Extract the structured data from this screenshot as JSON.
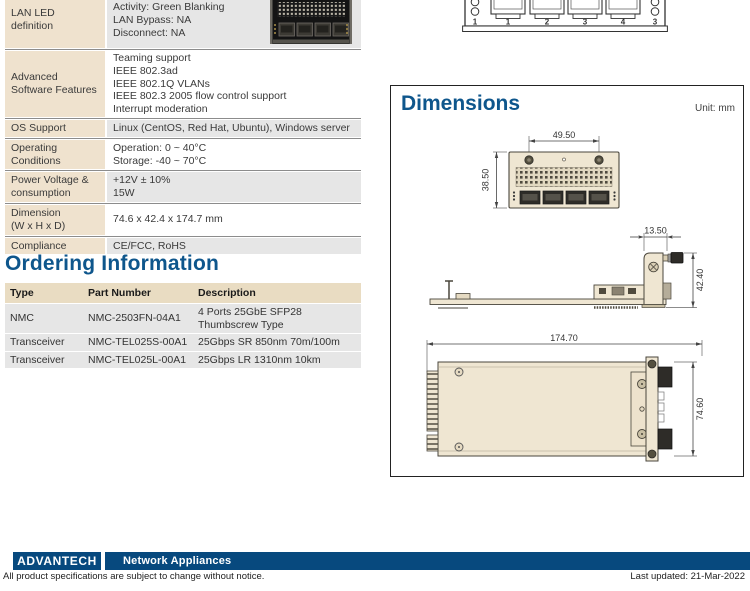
{
  "spec": {
    "rows": [
      {
        "label": "LAN LED definition",
        "value": "Activity: Green Blanking\nLAN Bypass: NA\nDisconnect: NA"
      },
      {
        "label": "Advanced Software Features",
        "value": "Teaming support\nIEEE 802.3ad\nIEEE 802.1Q VLANs\nIEEE 802.3 2005 flow control support\nInterrupt moderation"
      },
      {
        "label": "OS Support",
        "value": "Linux (CentOS, Red Hat, Ubuntu), Windows server"
      },
      {
        "label": "Operating Conditions",
        "value": "Operation: 0 ~ 40°C\nStorage: -40 ~ 70°C"
      },
      {
        "label": "Power Voltage &\nconsumption",
        "value": "+12V ± 10%\n15W"
      },
      {
        "label": "Dimension\n(W x H x D)",
        "value": "74.6 x 42.4 x 174.7 mm"
      },
      {
        "label": "Compliance",
        "value": "CE/FCC, RoHS"
      }
    ]
  },
  "ordering": {
    "title": "Ordering Information",
    "headers": [
      "Type",
      "Part Number",
      "Description"
    ],
    "rows": [
      {
        "type": "NMC",
        "part": "NMC-2503FN-04A1",
        "desc": "4 Ports 25GbE SFP28 Thumbscrew Type"
      },
      {
        "type": "Transceiver",
        "part": "NMC-TEL025S-00A1",
        "desc": "25Gbps SR 850nm 70m/100m"
      },
      {
        "type": "Transceiver",
        "part": "NMC-TEL025L-00A1",
        "desc": "25Gbps LR 1310nm 10km"
      }
    ]
  },
  "dimensions": {
    "title": "Dimensions",
    "unit_label": "Unit: mm",
    "front_width": "49.50",
    "front_height": "38.50",
    "side_width": "13.50",
    "side_height": "42.40",
    "top_length": "174.70",
    "top_width": "74.60"
  },
  "front_panel_drawing": {
    "port_labels": [
      "1",
      "2",
      "3",
      "4"
    ],
    "left_label": "1",
    "right_label": "3"
  },
  "footer": {
    "logo_text": "ADVANTECH",
    "category": "Network Appliances",
    "disclaimer": "All product specifications are subject to change without notice.",
    "last_updated": "Last updated: 21-Mar-2022"
  },
  "colors": {
    "heading_blue": "#0E568C",
    "brand_blue": "#07497E",
    "label_beige": "#EFE2CE",
    "row_gray": "#E6E6E6",
    "drawing_beige": "#EFE6D2"
  }
}
